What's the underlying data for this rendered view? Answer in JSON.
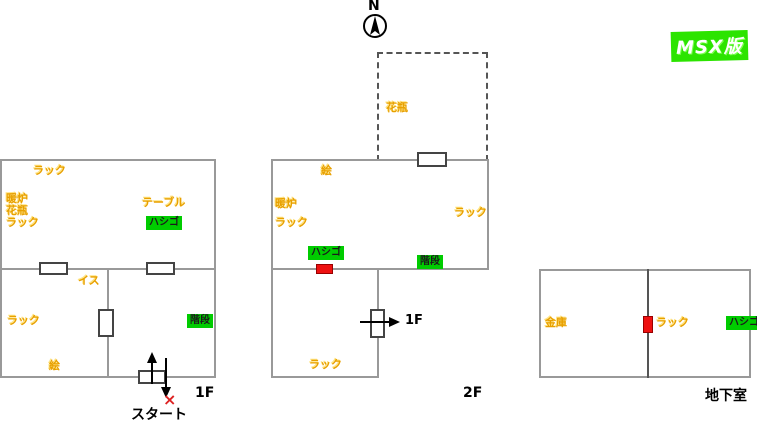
{
  "badge": {
    "text": "MSX版",
    "color": "#2CE400"
  },
  "compass": {
    "label": "N"
  },
  "colors": {
    "item_text": "#E8A000",
    "highlight_green": "#00CC00",
    "marker_red": "#EE1111",
    "wall_gray": "#999999"
  },
  "floor1": {
    "title": "1F",
    "items": {
      "rack_top": "ラック",
      "fireplace": "暖炉",
      "vase": "花瓶",
      "rack_left": "ラック",
      "table": "テーブル",
      "ladder": "ハシゴ",
      "chair": "イス",
      "rack_lower": "ラック",
      "picture": "絵",
      "stairs": "階段"
    },
    "start_label": "スタート",
    "start_marker": "×"
  },
  "floor2": {
    "title": "2F",
    "items": {
      "vase": "花瓶",
      "picture": "絵",
      "fireplace": "暖炉",
      "rack_left": "ラック",
      "rack_right": "ラック",
      "ladder": "ハシゴ",
      "stairs": "階段",
      "rack_lower": "ラック"
    },
    "exit_label": "1F"
  },
  "basement": {
    "title": "地下室",
    "items": {
      "safe": "金庫",
      "rack": "ラック",
      "ladder": "ハシゴ"
    }
  }
}
